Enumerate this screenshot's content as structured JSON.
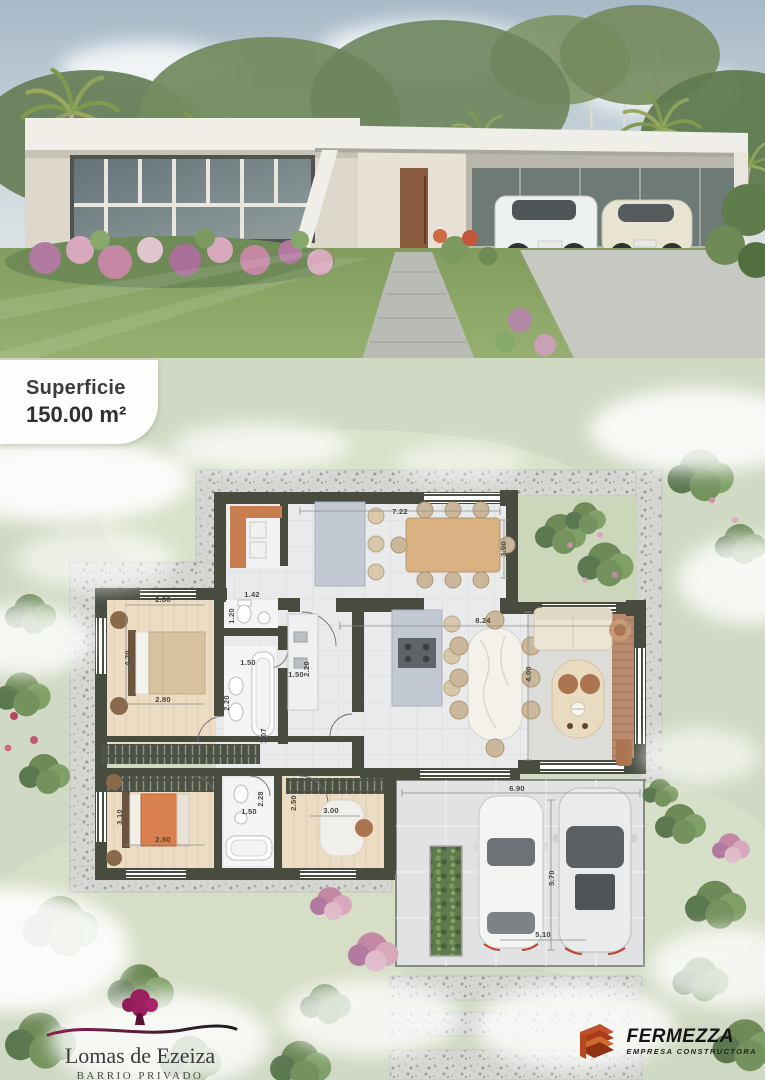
{
  "badge": {
    "label": "Superficie",
    "value": "150.00 m²"
  },
  "plan": {
    "area": "150.00 m²",
    "dimensions": [
      {
        "v": "7.22",
        "x": 400,
        "y": 514,
        "o": "h"
      },
      {
        "v": "3.00",
        "x": 506,
        "y": 549,
        "o": "v"
      },
      {
        "v": "1.42",
        "x": 252,
        "y": 597,
        "o": "h"
      },
      {
        "v": "2.80",
        "x": 163,
        "y": 602,
        "o": "h"
      },
      {
        "v": "1.20",
        "x": 234,
        "y": 616,
        "o": "v"
      },
      {
        "v": "4.20",
        "x": 130,
        "y": 658,
        "o": "v"
      },
      {
        "v": "1.50",
        "x": 248,
        "y": 665,
        "o": "h"
      },
      {
        "v": "2.20",
        "x": 229,
        "y": 703,
        "o": "v"
      },
      {
        "v": "2.80",
        "x": 163,
        "y": 702,
        "o": "h"
      },
      {
        "v": "8.24",
        "x": 483,
        "y": 623,
        "o": "h"
      },
      {
        "v": "4.00",
        "x": 531,
        "y": 674,
        "o": "v"
      },
      {
        "v": "1.50",
        "x": 296,
        "y": 677,
        "o": "h"
      },
      {
        "v": "2.20",
        "x": 309,
        "y": 669,
        "o": "v"
      },
      {
        "v": "1.07",
        "x": 266,
        "y": 736,
        "o": "v"
      },
      {
        "v": "2.80",
        "x": 163,
        "y": 842,
        "o": "h"
      },
      {
        "v": "3.10",
        "x": 122,
        "y": 817,
        "o": "v"
      },
      {
        "v": "1.50",
        "x": 249,
        "y": 814,
        "o": "h"
      },
      {
        "v": "2.28",
        "x": 263,
        "y": 799,
        "o": "v"
      },
      {
        "v": "2.50",
        "x": 296,
        "y": 803,
        "o": "v"
      },
      {
        "v": "3.00",
        "x": 331,
        "y": 813,
        "o": "h"
      },
      {
        "v": "6.90",
        "x": 517,
        "y": 791,
        "o": "h"
      },
      {
        "v": "5.70",
        "x": 554,
        "y": 878,
        "o": "v"
      },
      {
        "v": "5.10",
        "x": 543,
        "y": 937,
        "o": "h"
      }
    ]
  },
  "branding": {
    "community": {
      "name": "Lomas de Ezeiza",
      "tagline": "BARRIO PRIVADO"
    },
    "builder": {
      "name": "FERMEZZA",
      "tagline": "EMPRESA CONSTRUCTORA"
    }
  },
  "colors": {
    "wall": "#474c3f",
    "tile_floor": "#e9eaec",
    "wood_floor": "#ecdcc3",
    "deck": "#b98a6e",
    "plan_background": "#d0d9c3",
    "community_accent": "#9c1f60",
    "builder_accent": "#c2502a"
  }
}
